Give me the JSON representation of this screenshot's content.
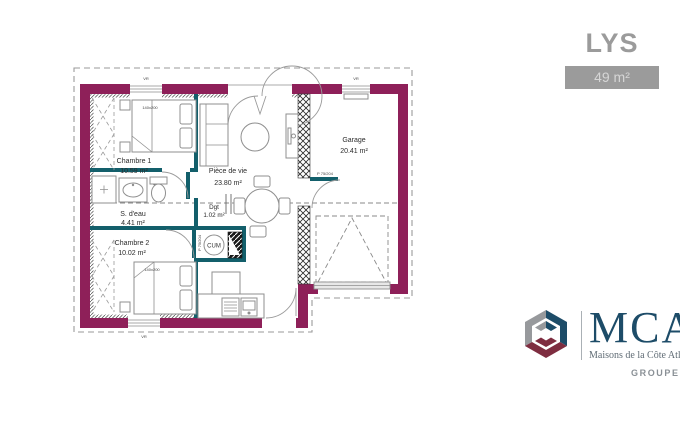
{
  "header": {
    "model_name": "LYS",
    "area_label": "49 m²"
  },
  "plan": {
    "rooms": {
      "chambre1": {
        "name": "Chambre 1",
        "area": "10.59 m²"
      },
      "sdeau": {
        "name": "S. d'eau",
        "area": "4.41 m²"
      },
      "chambre2": {
        "name": "Chambre 2",
        "area": "10.02 m²"
      },
      "piece_de_vie": {
        "name": "Pièce de vie",
        "area": "23.80 m²"
      },
      "dgt": {
        "name": "Dgt",
        "area": "1.02 m²"
      },
      "garage": {
        "name": "Garage",
        "area": "20.41 m²"
      }
    },
    "annotations": {
      "water_heater": "CUM",
      "bed_dimensions": "140x200",
      "door_label": "P 75/204",
      "shutter_label": "VR"
    },
    "colors": {
      "exterior_wall": "#8e2059",
      "partition": "#135f6b"
    }
  },
  "branding": {
    "logo_acronym": "MCA",
    "logo_full_name": "Maisons de la Côte Atlantique",
    "group_name": "GROUPE HexaOm",
    "colors": {
      "blue": "#1d4c68",
      "red": "#7e2d40",
      "gray": "#97999c"
    }
  }
}
